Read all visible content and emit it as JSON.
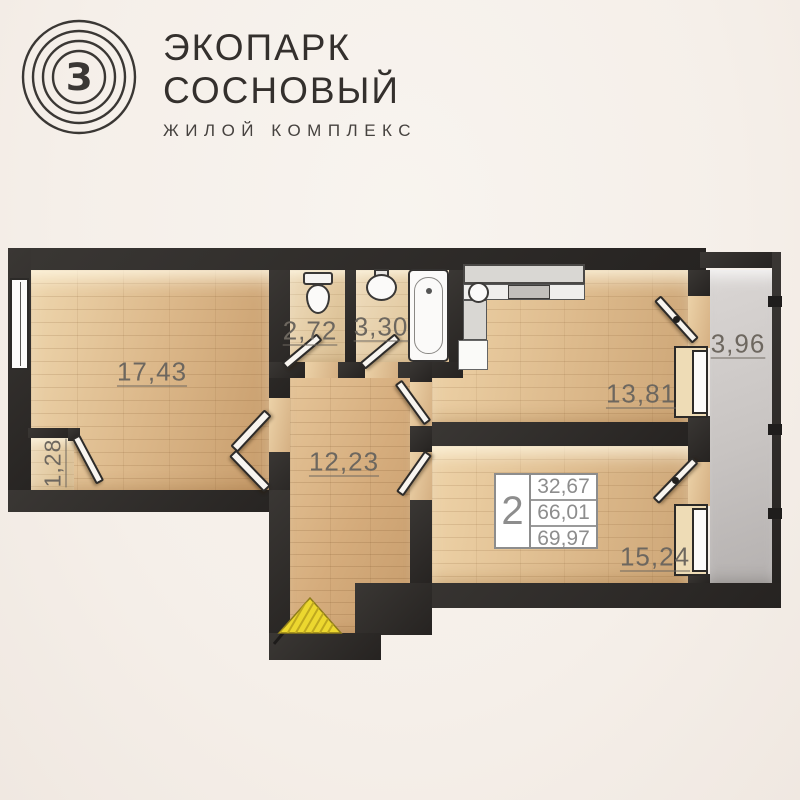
{
  "brand": {
    "title_line1": "ЭКОПАРК",
    "title_line2": "СОСНОВЫЙ",
    "subtitle": "ЖИЛОЙ КОМПЛЕКС",
    "logo": "concentric-circles-monogram",
    "logo_letter": "З"
  },
  "plan": {
    "type": "apartment-floor-plan",
    "rooms": [
      {
        "id": "living-room",
        "area": "17,43"
      },
      {
        "id": "closet",
        "area": "1,28"
      },
      {
        "id": "wc",
        "area": "2,72"
      },
      {
        "id": "bathroom",
        "area": "3,30"
      },
      {
        "id": "hallway",
        "area": "12,23"
      },
      {
        "id": "kitchen",
        "area": "13,81"
      },
      {
        "id": "bedroom",
        "area": "15,24"
      },
      {
        "id": "balcony",
        "area": "3,96"
      }
    ],
    "summary": {
      "rooms_count": "2",
      "living_area": "32,67",
      "area": "66,01",
      "total_area": "69,97"
    },
    "icons": {
      "entrance_marker": "yellow-hatched-triangle",
      "fixtures": [
        "toilet",
        "wash-basin",
        "bathtub",
        "kitchen-counter",
        "kitchen-sink",
        "stove"
      ]
    },
    "colors": {
      "background": "#f6f1ec",
      "wall": "#2d2b29",
      "wood": "#dcb88a",
      "balcony_floor": "#c8c4c2",
      "label_text": "#6d675f",
      "entrance_yellow": "#ecd72f",
      "brand_text": "#34302d"
    }
  }
}
